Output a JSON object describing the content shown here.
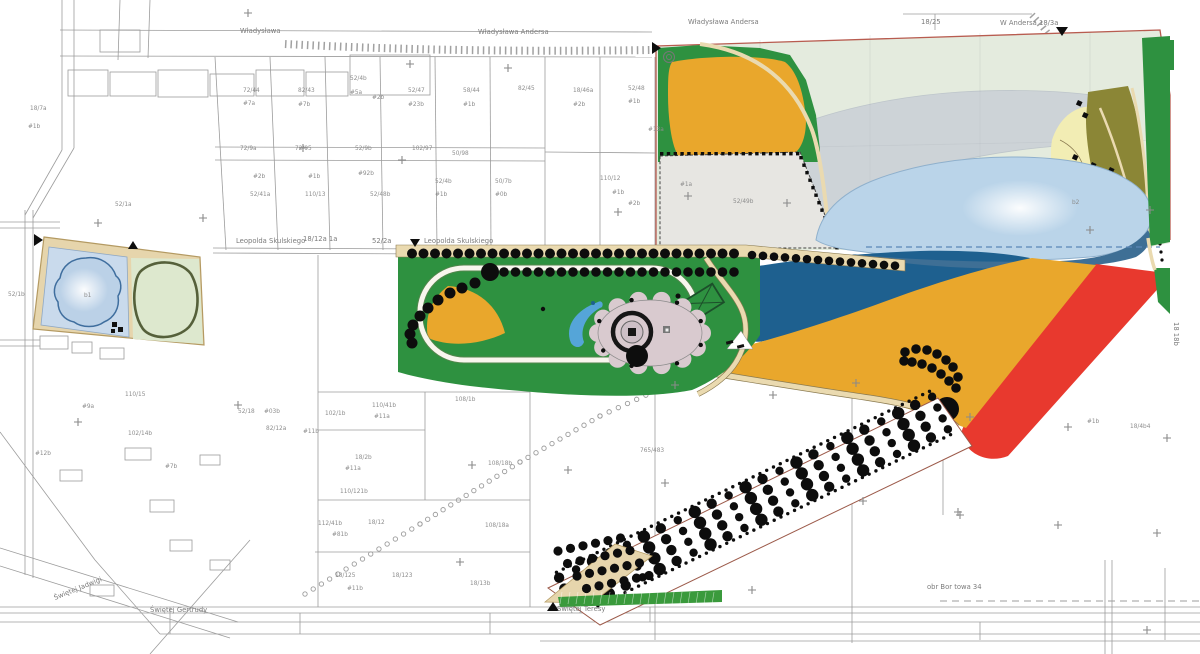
{
  "title": "Park site plan over cadastral map",
  "colors": {
    "park_green": "#2E9140",
    "orange": "#E9A72C",
    "sage": "#E4EBDE",
    "overlay": "#B7BDD1",
    "lake_blue": "#BAD4E9",
    "lake_edge": "#3E6F95",
    "pond_blue": "#1E608F",
    "red": "#E8392E",
    "red_outline": "#B85C50",
    "olive": "#8B8636",
    "beach": "#F2EDB4",
    "tan": "#EADAB0",
    "tan_edge": "#8A7A50",
    "gray_parcel": "#E7E6E2",
    "plaza_gray": "#D9CACF",
    "crescent_blue": "#55A5D8",
    "path_white": "#F8F6EE",
    "left_pond_panel": "#C9DAEC",
    "left_pond_water": "#BBD1E7",
    "left_panel_green": "#DDE8CE",
    "track_dark": "#55603A",
    "frame_tan": "#E6D5AC",
    "hatch_green": "#3A9A3C",
    "map_line": "#9C9C9C",
    "label_gray": "#8C8C8C",
    "street_gray": "#7B7B7B",
    "tree_black": "#0D0D0D",
    "dashed_blue": "#5B86B8",
    "court_stroke": "#1C4F2A"
  },
  "street_labels": [
    {
      "t": "Władysława",
      "x": 240,
      "y": 33
    },
    {
      "t": "Władysława Andersa",
      "x": 478,
      "y": 34
    },
    {
      "t": "Władysława Andersa",
      "x": 688,
      "y": 24
    },
    {
      "t": "18/25",
      "x": 921,
      "y": 24
    },
    {
      "t": "W Andersa 18/3a",
      "x": 1000,
      "y": 25
    },
    {
      "t": "Leopolda Skulskiego",
      "x": 236,
      "y": 243
    },
    {
      "t": "18/12a 1a",
      "x": 303,
      "y": 241
    },
    {
      "t": "52/2a",
      "x": 372,
      "y": 243
    },
    {
      "t": "Leopolda Skulskiego",
      "x": 424,
      "y": 243
    },
    {
      "t": "Świętej Gertrudy",
      "x": 150,
      "y": 612
    },
    {
      "t": "Świętej Jadwigi",
      "x": 55,
      "y": 600,
      "rot": -22
    },
    {
      "t": "Świętej Teresy",
      "x": 557,
      "y": 611
    },
    {
      "t": "obr Bor towa 34",
      "x": 927,
      "y": 589
    },
    {
      "t": "18 18b",
      "x": 1174,
      "y": 322,
      "rot": 90
    }
  ],
  "parcel_labels": [
    {
      "t": "72/44",
      "x": 243,
      "y": 92
    },
    {
      "t": "#7a",
      "x": 243,
      "y": 105
    },
    {
      "t": "82/43",
      "x": 298,
      "y": 92
    },
    {
      "t": "#7b",
      "x": 298,
      "y": 106
    },
    {
      "t": "52/4b",
      "x": 350,
      "y": 80
    },
    {
      "t": "#5a",
      "x": 350,
      "y": 94
    },
    {
      "t": "#2b",
      "x": 372,
      "y": 99
    },
    {
      "t": "52/47",
      "x": 408,
      "y": 92
    },
    {
      "t": "#23b",
      "x": 408,
      "y": 106
    },
    {
      "t": "58/44",
      "x": 463,
      "y": 92
    },
    {
      "t": "#1b",
      "x": 463,
      "y": 106
    },
    {
      "t": "82/45",
      "x": 518,
      "y": 90
    },
    {
      "t": "18/46a",
      "x": 573,
      "y": 92
    },
    {
      "t": "#2b",
      "x": 573,
      "y": 106
    },
    {
      "t": "52/48",
      "x": 628,
      "y": 90
    },
    {
      "t": "#1b",
      "x": 628,
      "y": 103
    },
    {
      "t": "#13a",
      "x": 648,
      "y": 131
    },
    {
      "t": "72/9a",
      "x": 240,
      "y": 150
    },
    {
      "t": "72/95",
      "x": 295,
      "y": 150
    },
    {
      "t": "52/9b",
      "x": 355,
      "y": 150
    },
    {
      "t": "102/97",
      "x": 412,
      "y": 150
    },
    {
      "t": "50/98",
      "x": 452,
      "y": 155
    },
    {
      "t": "#2b",
      "x": 253,
      "y": 178
    },
    {
      "t": "#1b",
      "x": 308,
      "y": 178
    },
    {
      "t": "#92b",
      "x": 358,
      "y": 175
    },
    {
      "t": "52/41a",
      "x": 250,
      "y": 196
    },
    {
      "t": "110/13",
      "x": 305,
      "y": 196
    },
    {
      "t": "52/48b",
      "x": 370,
      "y": 196
    },
    {
      "t": "52/4b",
      "x": 435,
      "y": 183
    },
    {
      "t": "#1b",
      "x": 435,
      "y": 196
    },
    {
      "t": "50/7b",
      "x": 495,
      "y": 183
    },
    {
      "t": "#0b",
      "x": 495,
      "y": 196
    },
    {
      "t": "110/12",
      "x": 600,
      "y": 180
    },
    {
      "t": "#1b",
      "x": 612,
      "y": 194
    },
    {
      "t": "#2b",
      "x": 628,
      "y": 205
    },
    {
      "t": "18/7a",
      "x": 30,
      "y": 110
    },
    {
      "t": "#1b",
      "x": 28,
      "y": 128
    },
    {
      "t": "52/1a",
      "x": 115,
      "y": 206
    },
    {
      "t": "52/1b",
      "x": 8,
      "y": 296
    },
    {
      "t": "#9a",
      "x": 82,
      "y": 408
    },
    {
      "t": "110/15",
      "x": 125,
      "y": 396
    },
    {
      "t": "102/14b",
      "x": 128,
      "y": 435
    },
    {
      "t": "52/18",
      "x": 238,
      "y": 413
    },
    {
      "t": "#03b",
      "x": 264,
      "y": 413
    },
    {
      "t": "82/12a",
      "x": 266,
      "y": 430
    },
    {
      "t": "#7b",
      "x": 165,
      "y": 468
    },
    {
      "t": "#12b",
      "x": 35,
      "y": 455
    },
    {
      "t": "102/1b",
      "x": 325,
      "y": 415
    },
    {
      "t": "108/1b",
      "x": 455,
      "y": 401
    },
    {
      "t": "110/41b",
      "x": 372,
      "y": 407
    },
    {
      "t": "#11a",
      "x": 374,
      "y": 418
    },
    {
      "t": "#11b",
      "x": 303,
      "y": 433
    },
    {
      "t": "18/2b",
      "x": 355,
      "y": 459
    },
    {
      "t": "#11a",
      "x": 345,
      "y": 470
    },
    {
      "t": "108/18b",
      "x": 488,
      "y": 465
    },
    {
      "t": "110/121b",
      "x": 340,
      "y": 493
    },
    {
      "t": "112/41b",
      "x": 318,
      "y": 525
    },
    {
      "t": "#81b",
      "x": 332,
      "y": 536
    },
    {
      "t": "18/12",
      "x": 368,
      "y": 524
    },
    {
      "t": "108/18a",
      "x": 485,
      "y": 527
    },
    {
      "t": "18/125",
      "x": 335,
      "y": 577
    },
    {
      "t": "18/123",
      "x": 392,
      "y": 577
    },
    {
      "t": "#11b",
      "x": 347,
      "y": 590
    },
    {
      "t": "18/13b",
      "x": 470,
      "y": 585
    },
    {
      "t": "765/483",
      "x": 640,
      "y": 452
    },
    {
      "t": "52/49b",
      "x": 733,
      "y": 203
    },
    {
      "t": "#1a",
      "x": 680,
      "y": 186
    },
    {
      "t": "#1b",
      "x": 1087,
      "y": 423
    },
    {
      "t": "18/4b4",
      "x": 1130,
      "y": 428
    },
    {
      "t": "b1",
      "x": 84,
      "y": 297
    },
    {
      "t": "b2",
      "x": 1072,
      "y": 204
    }
  ]
}
